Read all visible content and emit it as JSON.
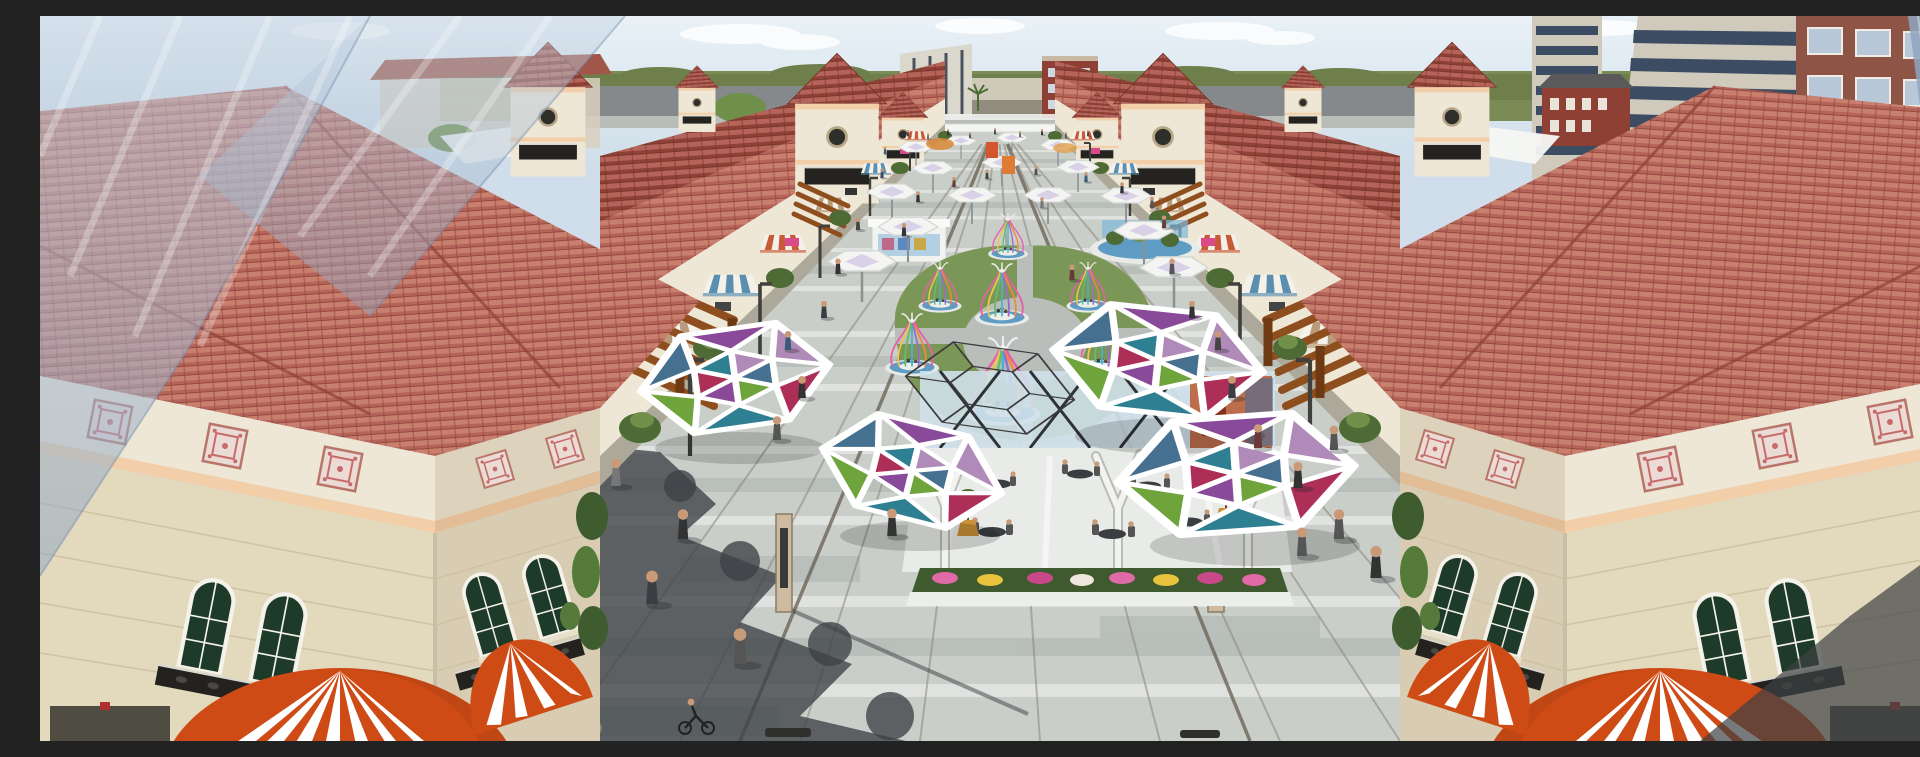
{
  "scene": {
    "type": "3d-architectural-rendering",
    "subject": "aerial view of an outdoor Mediterranean-style pedestrian shopping plaza",
    "regions": {
      "sky": "pale blue sky with thin white clouds",
      "background": "city apartment towers, brick buildings and green treeline at horizon",
      "left_buildings": "cream retail buildings with red clay tile roofs, wood pergolas, striped awnings and gate towers",
      "right_buildings": "mirrored cream retail buildings with red clay tile roofs, pergolas and awnings",
      "plaza": "long gray paved pedestrian plaza crowded with people",
      "center_features": "white umbrellas, ribbon birdcage pavilions on blue water rings around a lawn, stained-glass geometric canopies, outdoor cafe terrace with flower beds",
      "foreground": "orange and white striped dome awnings at building entrances"
    },
    "counts": {
      "umbrellas": 15,
      "birdcage_pavilions": 7,
      "geometric_canopies": 4,
      "gate_towers": 4,
      "dome_awnings": 4,
      "people_approx": 60
    }
  },
  "palette": {
    "sky_top": "#e6eef5",
    "sky_bot": "#cfdeea",
    "cloud": "#ffffff",
    "treeline": "#6f7f4b",
    "grass": "#7b8b55",
    "road": "#85898c",
    "sidewalk": "#b9bdb9",
    "paving": "#c9cec9",
    "paving_light": "#dfe2de",
    "paving_dark": "#a9afab",
    "joint": "#8a857c",
    "joint_dark": "#6d655a",
    "shadow": "#3d4145",
    "roof": "#b5645a",
    "roof_hi": "#c87f6e",
    "roof_dark": "#8e4136",
    "eave": "#f2e9d6",
    "wall": "#efe7d5",
    "wall_shade": "#ddd2bb",
    "stone": "#e3d9bd",
    "stone_shade": "#d8cdb2",
    "cornice": "#f2cfa8",
    "glass": "#1e3b2a",
    "frame": "#f5f2ea",
    "iron": "#23221f",
    "tileart_bg": "#eadcd4",
    "tileart_fg": "#c96a6a",
    "pergola": "#8e4e1e",
    "pergola_dark": "#6e3a14",
    "awn_red": "#c85a3a",
    "awn_blue": "#5b8fb0",
    "awn_tan": "#b99a7a",
    "dome": "#cf4b16",
    "white": "#f4f5f2",
    "p_crimson": "#ad2f58",
    "p_teal": "#2f7f93",
    "p_green": "#6fa33c",
    "p_slate": "#46708f",
    "p_purple": "#8a4a9a",
    "p_mauve": "#b08ab8",
    "cage_pink": "#e75fa5",
    "cage_yellow": "#ecc84a",
    "cage_green": "#66bb6a",
    "cage_cyan": "#44b5c9",
    "cage_purple": "#9a6cc9",
    "cage_orange": "#ef8a3d",
    "water": "#5e9cc4",
    "water_light": "#7fb9da",
    "lawn": "#7b9757",
    "ring": "#b9beba",
    "fl_pink": "#e06aa8",
    "fl_yellow": "#e8c43c",
    "fl_magenta": "#c8488a",
    "fl_white": "#ece8e0",
    "bed": "#3e5a2e",
    "foliage": "#4e6b35",
    "foliage_hi": "#6f8f4a",
    "tower_beige": "#cfcabb",
    "tower_band": "#3c4c63",
    "tower_brick": "#8e5547",
    "brick": "#8f4034",
    "slab": "#dad7cc",
    "glassblue": "#8fa6c0",
    "glassblue_hi": "#c3d2e2",
    "skin": "#c89a78",
    "pot": "#c8923a",
    "kiosk_orange": "#d4552e",
    "kiosk_orange2": "#e07b35",
    "lamp": "#3f3f3b",
    "kioskbeige": "#cdbaa0",
    "cafe_glass": "#cfe0ea",
    "cafe_orange": "#b85a30",
    "trunk": "#f2f2ef"
  }
}
